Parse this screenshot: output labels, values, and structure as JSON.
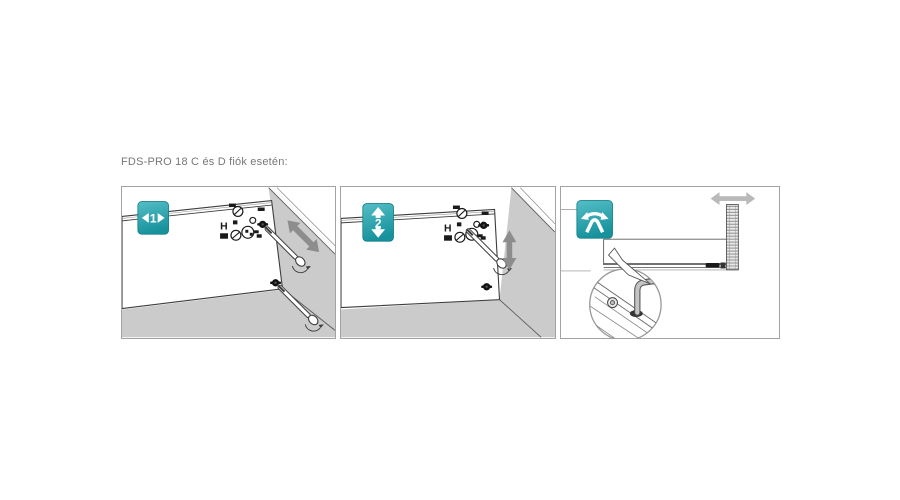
{
  "header": {
    "title": "FDS-PRO 18 C és D fiók esetén:"
  },
  "markings": {
    "label": "H"
  },
  "panels": [
    {
      "step": "step-1",
      "badge_label": "1",
      "badge_icon": "left-right-arrows-badge",
      "icons": [
        "screwdriver-icon",
        "screw-icon",
        "diagonal-double-arrow-icon",
        "height-adjust-markings"
      ]
    },
    {
      "step": "step-2",
      "badge_label": "2",
      "badge_icon": "up-down-arrows-badge",
      "icons": [
        "screwdriver-icon",
        "screw-icon",
        "vertical-double-arrow-icon",
        "height-adjust-markings"
      ]
    },
    {
      "step": "step-3",
      "badge_label": "",
      "badge_icon": "tilt-adjust-badge",
      "icons": [
        "horizontal-double-arrow-icon",
        "threaded-screw-icon",
        "detail-magnifier-circle",
        "hook-clip-icon"
      ]
    }
  ],
  "colors": {
    "badge_teal": "#17929c",
    "badge_teal_light": "#55bec6",
    "wall_gray": "#cbcbcb",
    "arrow_gray": "#8d8d8d",
    "light_arrow_gray": "#b9b9b9",
    "panel_border": "#a3a3a3",
    "header_text": "#777777"
  }
}
